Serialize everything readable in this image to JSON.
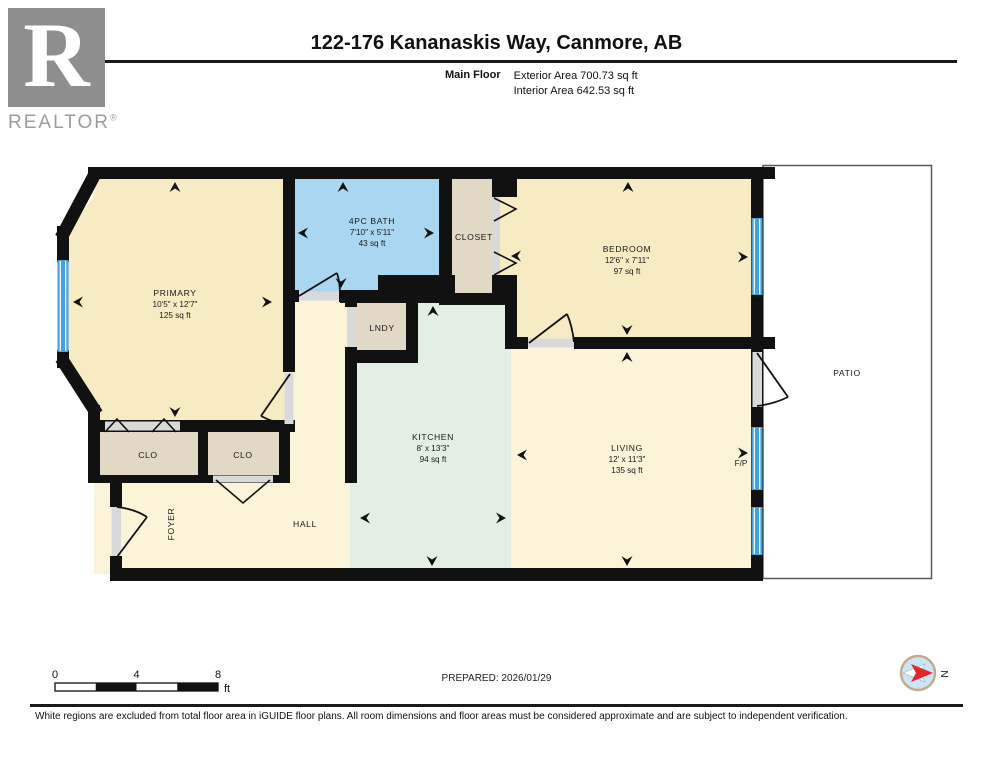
{
  "header": {
    "logo_letter": "R",
    "logo_text": "REALTOR",
    "logo_reg": "®",
    "title": "122-176 Kananaskis Way, Canmore, AB",
    "floor_label": "Main Floor",
    "exterior_area": "Exterior Area 700.73 sq ft",
    "interior_area": "Interior Area 642.53 sq ft"
  },
  "rooms": {
    "primary": {
      "name": "PRIMARY",
      "dims": "10'5\" x 12'7\"",
      "area": "125 sq ft"
    },
    "bath": {
      "name": "4PC BATH",
      "dims": "7'10\" x 5'11\"",
      "area": "43 sq ft"
    },
    "closet": {
      "name": "CLOSET"
    },
    "bedroom": {
      "name": "BEDROOM",
      "dims": "12'6\" x 7'11\"",
      "area": "97 sq ft"
    },
    "lndy": {
      "name": "LNDY"
    },
    "kitchen": {
      "name": "KITCHEN",
      "dims": "8' x 13'3\"",
      "area": "94 sq ft"
    },
    "living": {
      "name": "LIVING",
      "dims": "12' x 11'3\"",
      "area": "135 sq ft"
    },
    "clo_left": {
      "name": "CLO"
    },
    "clo_right": {
      "name": "CLO"
    },
    "foyer": {
      "name": "FOYER"
    },
    "hall": {
      "name": "HALL"
    },
    "fireplace": {
      "name": "F/P"
    },
    "patio": {
      "name": "PATIO"
    }
  },
  "scale_bar": {
    "tick0": "0",
    "tick4": "4",
    "tick8": "8",
    "unit": "ft"
  },
  "prepared_label": "PREPARED: 2026/01/29",
  "compass": {
    "label": "N"
  },
  "disclaimer": "White regions are excluded from total floor area in iGUIDE floor plans. All room dimensions and floor areas must be considered approximate and are subject to independent verification.",
  "colors": {
    "wall": "#111111",
    "room_cream": "#F7EBC4",
    "room_pale": "#FBF4D9",
    "bath_blue": "#A9D6F0",
    "kitchen_green": "#E3EFE5",
    "closet_tan": "#E2D8C6",
    "window_blue": "#45A2D8",
    "door_gray": "#D9D9D9",
    "compass_red": "#E2262E"
  }
}
